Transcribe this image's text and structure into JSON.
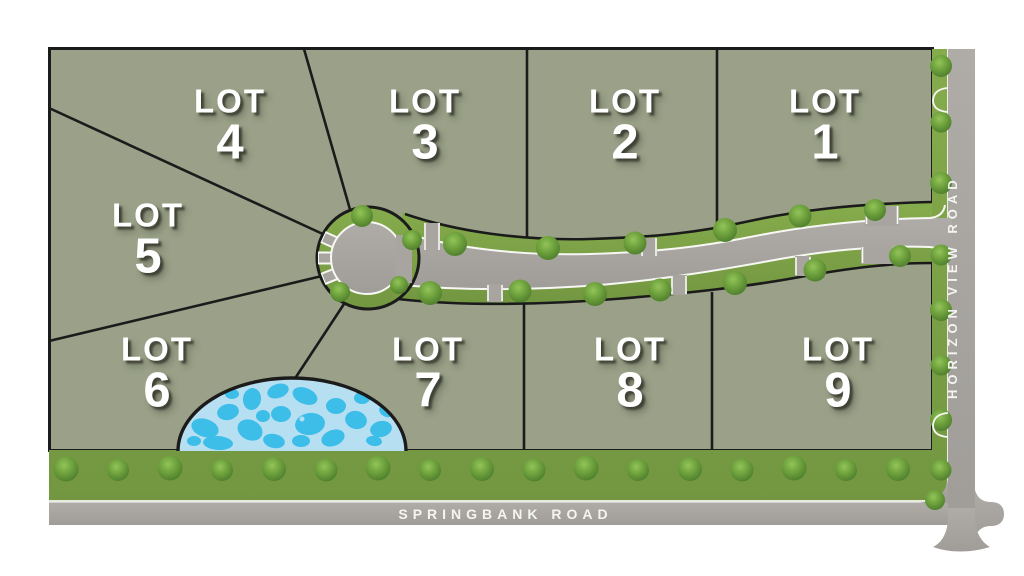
{
  "lots": [
    {
      "word": "LOT",
      "number": "1"
    },
    {
      "word": "LOT",
      "number": "2"
    },
    {
      "word": "LOT",
      "number": "3"
    },
    {
      "word": "LOT",
      "number": "4"
    },
    {
      "word": "LOT",
      "number": "5"
    },
    {
      "word": "LOT",
      "number": "6"
    },
    {
      "word": "LOT",
      "number": "7"
    },
    {
      "word": "LOT",
      "number": "8"
    },
    {
      "word": "LOT",
      "number": "9"
    }
  ],
  "roads": {
    "bottom": {
      "name": "SPRINGBANK ROAD"
    },
    "right": {
      "name": "HORIZON VIEW ROAD"
    }
  },
  "colors": {
    "lot_fill": "#9AA188",
    "grass": "#7CA046",
    "bush": "#5E9334",
    "road": "#A8A5A1",
    "road_line": "#F7F7F3",
    "pond_base": "#B7DFF2",
    "pond_accent": "#3DBEE9",
    "outline": "#1B1B1B",
    "label_text": "#FFFFFF"
  }
}
